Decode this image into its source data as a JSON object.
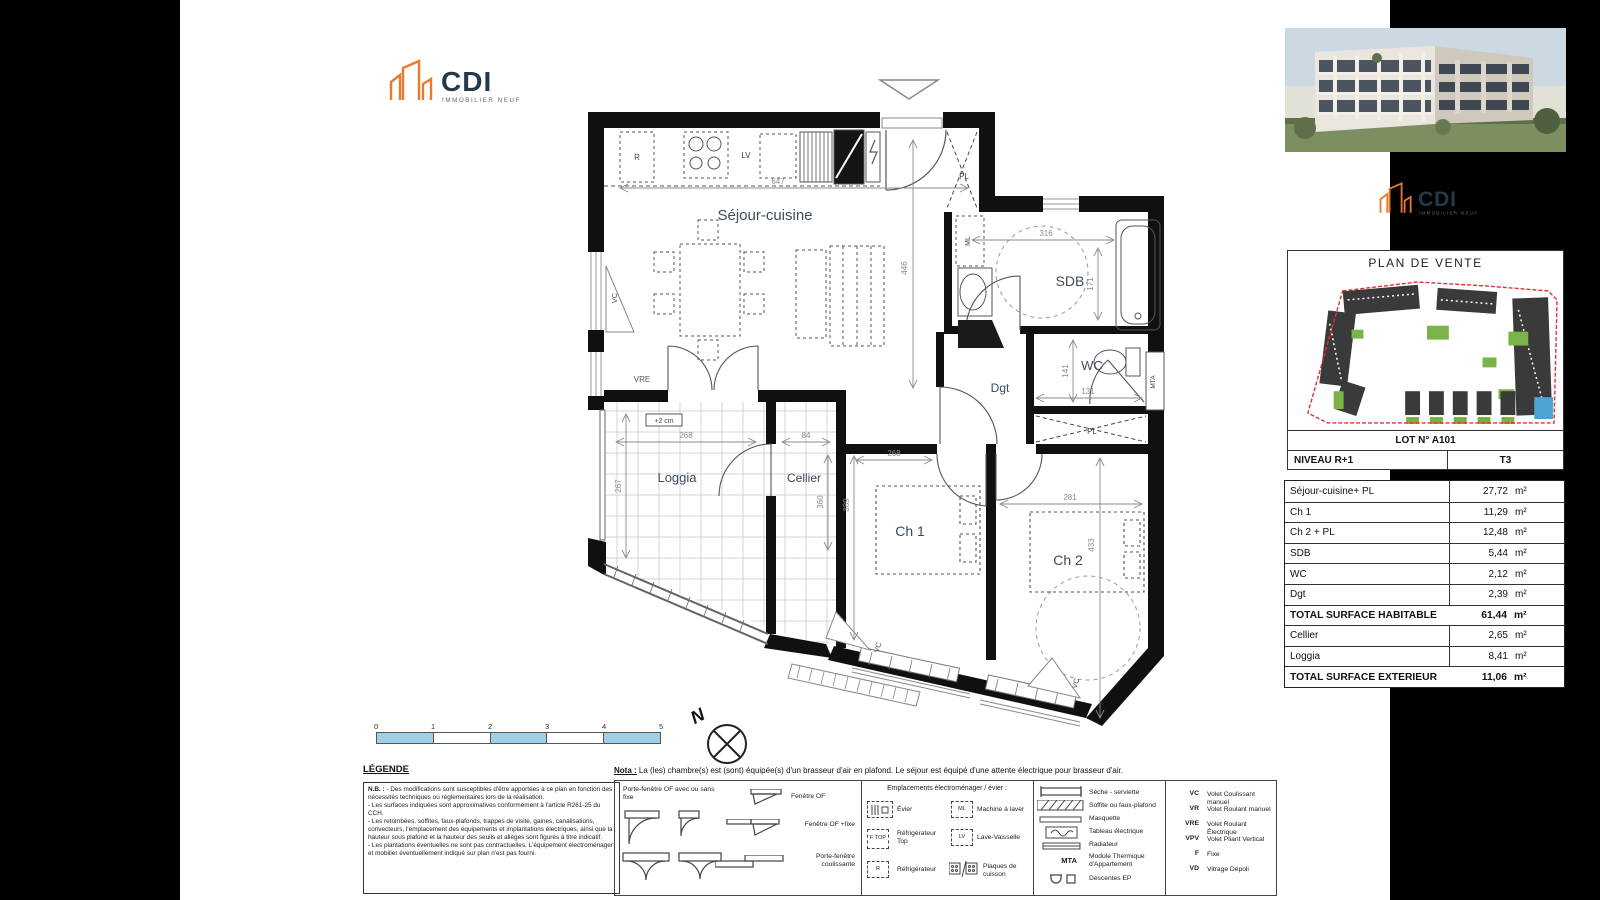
{
  "logo": {
    "brand": "CDI",
    "tagline": "IMMOBILIER NEUF",
    "orange": "#e87a2e",
    "navy": "#243a4c"
  },
  "plan": {
    "labels": {
      "sejour": "Séjour-cuisine",
      "sdb": "SDB",
      "wc": "WC",
      "dgt": "Dgt",
      "ch1": "Ch 1",
      "ch2": "Ch 2",
      "loggia": "Loggia",
      "cellier": "Cellier"
    },
    "ann": {
      "r": "R",
      "lv": "LV",
      "ml": "ML",
      "pl": "PL",
      "mta": "MTA",
      "vc": "VC",
      "vre": "VRE",
      "plus2": "+2 cm"
    },
    "dims": {
      "d_top": "647",
      "d_sejour_h": "446",
      "d_sdb_w": "316",
      "d_sdb_h": "171",
      "d_wc_h": "141",
      "d_wc_w": "131",
      "d_ch1_w": "268",
      "d_ch1_h": "389",
      "d_ch2_w": "281",
      "d_ch2_h": "433",
      "d_log_w": "268",
      "d_log_h": "267",
      "d_cel_w": "84",
      "d_cel_h": "360"
    }
  },
  "compass": {
    "label": "N"
  },
  "scalebar": {
    "ticks": [
      "0",
      "1",
      "2",
      "3",
      "4",
      "5"
    ]
  },
  "legend": {
    "title": "LÉGENDE",
    "nb_label": "N.B. :",
    "nb": [
      "- Des modifications sont susceptibles d'être apportées à ce plan en fonction des nécessités techniques ou réglementaires lors de la réalisation.",
      "- Les surfaces indiquées sont approximatives conformément à l'article R261-25 du CCH.",
      "- Les retombées, soffites, faux-plafonds, trappes de visite, gaines, canalisations, convecteurs, l'emplacement des équipements et implantations électriques, ainsi que la hauteur sous plafond et la hauteur des seuils et allèges sont figurés à titre indicatif.",
      "- Les plantations éventuelles ne sont pas contractuelles. L'équipement électroménager et mobilier éventuellement indiqué sur plan n'est pas fourni."
    ],
    "nota_label": "Nota :",
    "nota_text": "La (les) chambre(s) est (sont) équipée(s) d'un brasseur d'air en plafond. Le séjour est équipé d'une attente électrique pour brasseur d'air.",
    "openings": [
      {
        "label": "Porte-fenêtre OF avec ou sans fixe"
      },
      {
        "label": "Fenêtre OF"
      },
      {
        "label": "Fenêtre OF +fixe"
      },
      {
        "label": "Porte-fenêtre coulissante"
      }
    ],
    "appliances": {
      "header": "Emplacements électroménager / évier :",
      "items": [
        {
          "abbr": "",
          "label": "Évier"
        },
        {
          "abbr": "ML",
          "label": "Machine à laver"
        },
        {
          "abbr": "F TOP",
          "label": "Réfrigérateur Top"
        },
        {
          "abbr": "LV",
          "label": "Lave-Vaisselle"
        },
        {
          "abbr": "R",
          "label": "Réfrigérateur"
        },
        {
          "abbr": "",
          "label": "Plaques de cuisson"
        }
      ]
    },
    "symbols": [
      {
        "abbr": "",
        "label": "Sèche - serviette"
      },
      {
        "abbr": "",
        "label": "Soffite ou faux-plafond"
      },
      {
        "abbr": "",
        "label": "Masquette"
      },
      {
        "abbr": "",
        "label": "Tableau électrique"
      },
      {
        "abbr": "",
        "label": "Radiateur"
      },
      {
        "abbr": "MTA",
        "label": "Module Thermique d'Appartement"
      },
      {
        "abbr": "",
        "label": "Descentes EP"
      }
    ],
    "shutters": [
      {
        "abbr": "VC",
        "label": "Volet Coulissant manuel"
      },
      {
        "abbr": "VR",
        "label": "Volet Roulant manuel"
      },
      {
        "abbr": "VRE",
        "label": "Volet Roulant Électrique"
      },
      {
        "abbr": "VPV",
        "label": "Volet Pliant Vertical"
      },
      {
        "abbr": "F",
        "label": "Fixe"
      },
      {
        "abbr": "VD",
        "label": "Vitrage Dépoli"
      }
    ]
  },
  "panel": {
    "title": "PLAN DE VENTE",
    "lot": "LOT N° A101",
    "niveau": "NIVEAU R+1",
    "type_label": "T3",
    "surfaces": [
      {
        "label": "Séjour-cuisine+ PL",
        "value": "27,72",
        "unit": "m²"
      },
      {
        "label": "Ch 1",
        "value": "11,29",
        "unit": "m²"
      },
      {
        "label": "Ch 2 + PL",
        "value": "12,48",
        "unit": "m²"
      },
      {
        "label": "SDB",
        "value": "5,44",
        "unit": "m²"
      },
      {
        "label": "WC",
        "value": "2,12",
        "unit": "m²"
      },
      {
        "label": "Dgt",
        "value": "2,39",
        "unit": "m²"
      },
      {
        "label": "TOTAL SURFACE HABITABLE",
        "value": "61,44",
        "unit": "m²"
      },
      {
        "label": "Cellier",
        "value": "2,65",
        "unit": "m²"
      },
      {
        "label": "Loggia",
        "value": "8,41",
        "unit": "m²"
      },
      {
        "label": "TOTAL SURFACE EXTERIEUR",
        "value": "11,06",
        "unit": "m²"
      }
    ]
  }
}
